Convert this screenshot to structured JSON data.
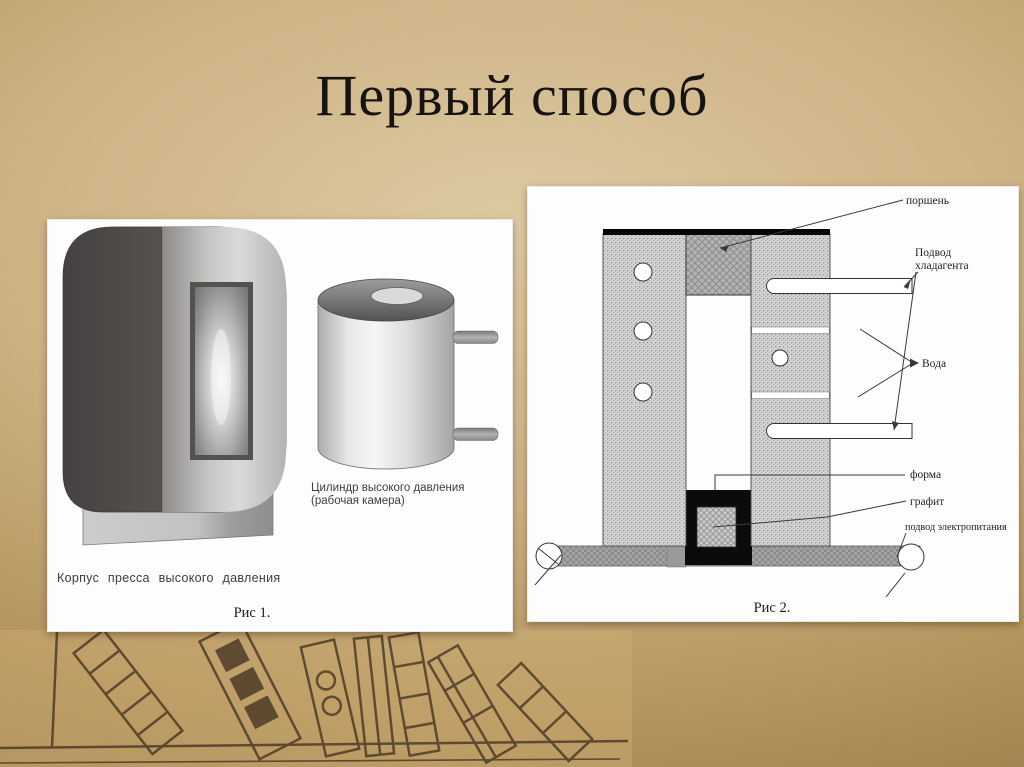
{
  "slide": {
    "title": "Первый способ"
  },
  "figure1": {
    "cylinder_label_line1": "Цилиндр высокого давления",
    "cylinder_label_line2": "(рабочая камера)",
    "body_label": "Корпус пресса высокого давления",
    "caption": "Рис 1."
  },
  "figure2": {
    "labels": {
      "piston": "поршень",
      "coolant_line1": "Подвод",
      "coolant_line2": "хладагента",
      "water": "Вода",
      "mold": "форма",
      "graphite": "графит",
      "power": "подвод электропитания"
    },
    "caption": "Рис 2."
  },
  "colors": {
    "background_center": "#ddcaa2",
    "background_edge": "#8f7345",
    "panel": "#fdfdfd",
    "title_text": "#161310",
    "diagram_line": "#3a3a3a",
    "sketch_brown": "#4a3825",
    "mold_black": "#0b0b0b",
    "metal_gray": "#9a9a9a"
  }
}
